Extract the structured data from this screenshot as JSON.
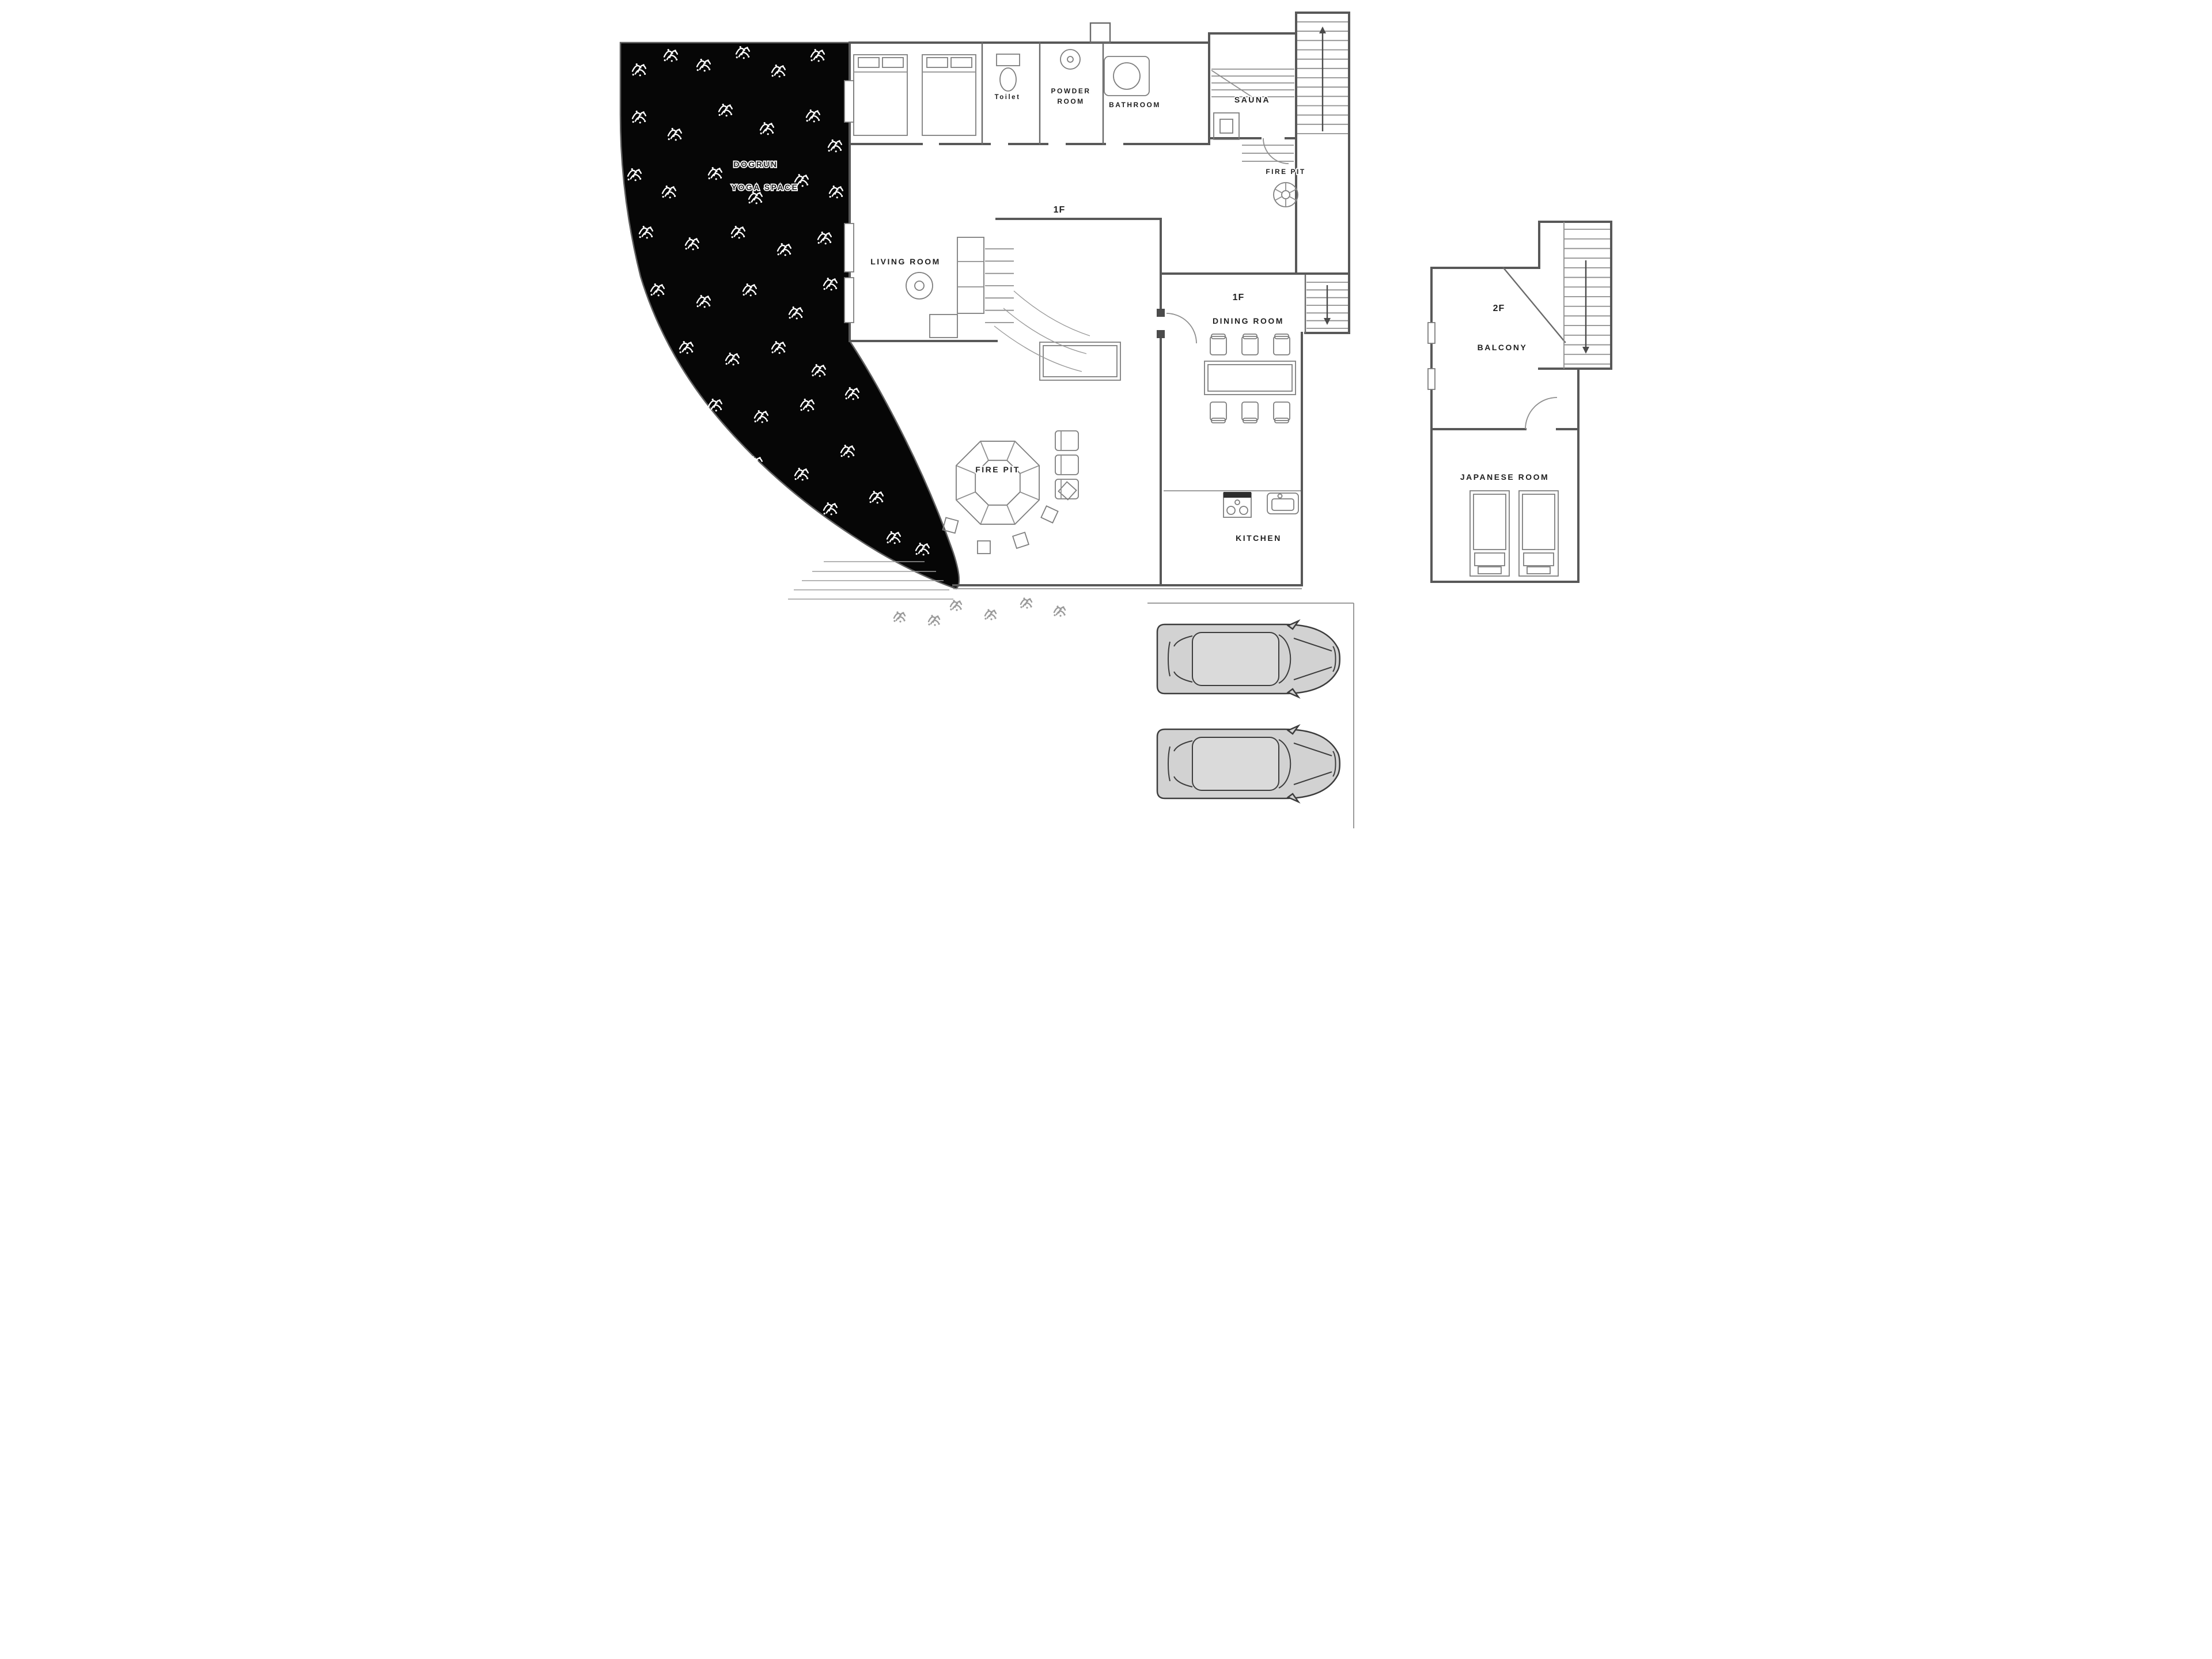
{
  "title": "house-floor-plan",
  "colors": {
    "background": "#ffffff",
    "ink": "#3c3c3c",
    "wall": "#585858",
    "thin_line": "#8f8f8f",
    "ground_fill": "#060606",
    "grass_mark": "#ffffff",
    "car_body": "#d2d2d2",
    "label_text": "#1f1f1f"
  },
  "site": {
    "dogrun_label": "DOGRUN",
    "yoga_space_label": "YOGA SPACE"
  },
  "floor1": {
    "floor_marker_hall": "1F",
    "floor_marker_dining": "1F",
    "rooms": {
      "toilet": "Toilet",
      "powder_room_line1": "POWDER",
      "powder_room_line2": "ROOM",
      "bathroom": "BATHROOM",
      "sauna": "SAUNA",
      "fire_pit_terrace": "FIRE PIT",
      "living_room": "LIVING ROOM",
      "dining_room": "DINING ROOM",
      "fire_pit_deck": "FIRE PIT",
      "kitchen": "KITCHEN"
    }
  },
  "floor2": {
    "floor_marker": "2F",
    "rooms": {
      "balcony": "BALCONY",
      "japanese_room": "JAPANESE ROOM"
    }
  },
  "parking": {
    "car_count": 2
  }
}
